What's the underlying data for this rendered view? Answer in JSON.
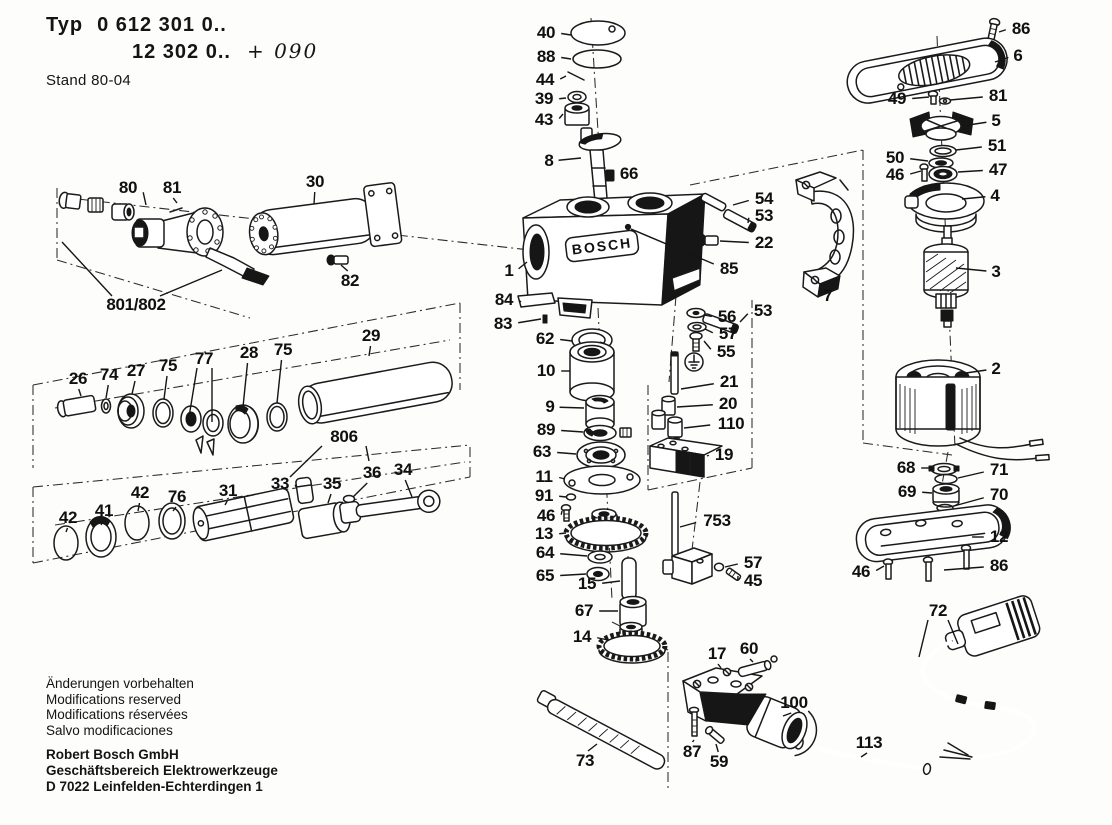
{
  "header": {
    "typ_label": "Typ",
    "line1": "0 612 301 0..",
    "line2": "12 302 0..",
    "handwritten": "+ 090",
    "stand": "Stand 80-04"
  },
  "logo_text": "BOSCH",
  "footer": {
    "notes": [
      "Änderungen vorbehalten",
      "Modifications reserved",
      "Modifications réservées",
      "Salvo modificaciones"
    ],
    "company": [
      "Robert Bosch GmbH",
      "Geschäftsbereich Elektrowerkzeuge",
      "D 7022 Leinfelden-Echterdingen 1"
    ]
  },
  "parts": [
    {
      "id": "p40",
      "label": "40",
      "x": 546,
      "y": 33,
      "tx": 571,
      "ty": 35
    },
    {
      "id": "p88",
      "label": "88",
      "x": 546,
      "y": 57,
      "tx": 571,
      "ty": 59
    },
    {
      "id": "p44",
      "label": "44",
      "x": 545,
      "y": 80,
      "tx": 566,
      "ty": 76
    },
    {
      "id": "p39",
      "label": "39",
      "x": 544,
      "y": 99,
      "tx": 566,
      "ty": 98
    },
    {
      "id": "p43",
      "label": "43",
      "x": 544,
      "y": 120,
      "tx": 563,
      "ty": 114
    },
    {
      "id": "p8",
      "label": "8",
      "x": 549,
      "y": 161,
      "tx": 581,
      "ty": 158
    },
    {
      "id": "p66",
      "label": "66",
      "x": 629,
      "y": 174,
      "tx": 613,
      "ty": 175
    },
    {
      "id": "p86a",
      "label": "86",
      "x": 1021,
      "y": 29,
      "tx": 999,
      "ty": 32
    },
    {
      "id": "p6",
      "label": "6",
      "x": 1018,
      "y": 56,
      "tx": 995,
      "ty": 62
    },
    {
      "id": "p49",
      "label": "49",
      "x": 897,
      "y": 99,
      "tx": 929,
      "ty": 97
    },
    {
      "id": "p81b",
      "label": "81",
      "x": 998,
      "y": 96,
      "tx": 950,
      "ty": 100
    },
    {
      "id": "p5",
      "label": "5",
      "x": 996,
      "y": 121,
      "tx": 962,
      "ty": 126
    },
    {
      "id": "p51",
      "label": "51",
      "x": 997,
      "y": 146,
      "tx": 956,
      "ty": 150
    },
    {
      "id": "p50",
      "label": "50",
      "x": 895,
      "y": 158,
      "tx": 928,
      "ty": 161
    },
    {
      "id": "p46b",
      "label": "46",
      "x": 895,
      "y": 175,
      "tx": 921,
      "ty": 171
    },
    {
      "id": "p47",
      "label": "47",
      "x": 998,
      "y": 170,
      "tx": 958,
      "ty": 172
    },
    {
      "id": "p4",
      "label": "4",
      "x": 995,
      "y": 196,
      "tx": 962,
      "ty": 199
    },
    {
      "id": "p3",
      "label": "3",
      "x": 996,
      "y": 272,
      "tx": 956,
      "ty": 268
    },
    {
      "id": "p2",
      "label": "2",
      "x": 996,
      "y": 369,
      "tx": 966,
      "ty": 373
    },
    {
      "id": "p80",
      "label": "80",
      "x": 128,
      "y": 188,
      "tx": 146,
      "ty": 205
    },
    {
      "id": "p81a",
      "label": "81",
      "x": 172,
      "y": 188,
      "tx": 177,
      "ty": 203
    },
    {
      "id": "p30",
      "label": "30",
      "x": 315,
      "y": 182,
      "tx": 314,
      "ty": 204
    },
    {
      "id": "p82",
      "label": "82",
      "x": 350,
      "y": 281,
      "tx": 341,
      "ty": 265
    },
    {
      "id": "p801",
      "label": "801/802",
      "x": 136,
      "y": 305
    },
    {
      "id": "p54",
      "label": "54",
      "x": 764,
      "y": 199,
      "tx": 733,
      "ty": 205
    },
    {
      "id": "p53a",
      "label": "53",
      "x": 764,
      "y": 216,
      "tx": 748,
      "ty": 223
    },
    {
      "id": "p22",
      "label": "22",
      "x": 764,
      "y": 243,
      "tx": 720,
      "ty": 241
    },
    {
      "id": "p85",
      "label": "85",
      "x": 729,
      "y": 269,
      "tx": 631,
      "ty": 229
    },
    {
      "id": "p1",
      "label": "1",
      "x": 509,
      "y": 271,
      "tx": 527,
      "ty": 262
    },
    {
      "id": "p84",
      "label": "84",
      "x": 504,
      "y": 300,
      "tx": 521,
      "ty": 302
    },
    {
      "id": "p83",
      "label": "83",
      "x": 503,
      "y": 324,
      "tx": 541,
      "ty": 319
    },
    {
      "id": "p53b",
      "label": "53",
      "x": 763,
      "y": 311,
      "tx": 740,
      "ty": 322
    },
    {
      "id": "p56",
      "label": "56",
      "x": 727,
      "y": 317,
      "tx": 704,
      "ty": 315
    },
    {
      "id": "p57a",
      "label": "57",
      "x": 728,
      "y": 334,
      "tx": 705,
      "ty": 329
    },
    {
      "id": "p55",
      "label": "55",
      "x": 726,
      "y": 352,
      "tx": 704,
      "ty": 341
    },
    {
      "id": "p26",
      "label": "26",
      "x": 78,
      "y": 379,
      "tx": 81,
      "ty": 396
    },
    {
      "id": "p74",
      "label": "74",
      "x": 109,
      "y": 375,
      "tx": 106,
      "ty": 398
    },
    {
      "id": "p27",
      "label": "27",
      "x": 136,
      "y": 371,
      "tx": 132,
      "ty": 394
    },
    {
      "id": "p75a",
      "label": "75",
      "x": 168,
      "y": 366,
      "tx": 164,
      "ty": 399
    },
    {
      "id": "p77",
      "label": "77",
      "x": 204,
      "y": 359
    },
    {
      "id": "p28",
      "label": "28",
      "x": 249,
      "y": 353,
      "tx": 243,
      "ty": 407
    },
    {
      "id": "p75b",
      "label": "75",
      "x": 283,
      "y": 350,
      "tx": 277,
      "ty": 403
    },
    {
      "id": "p29",
      "label": "29",
      "x": 371,
      "y": 336,
      "tx": 369,
      "ty": 356
    },
    {
      "id": "p62",
      "label": "62",
      "x": 545,
      "y": 339,
      "tx": 572,
      "ty": 341
    },
    {
      "id": "p10",
      "label": "10",
      "x": 546,
      "y": 371,
      "tx": 570,
      "ty": 371
    },
    {
      "id": "p9",
      "label": "9",
      "x": 550,
      "y": 407,
      "tx": 584,
      "ty": 408
    },
    {
      "id": "p89",
      "label": "89",
      "x": 546,
      "y": 430,
      "tx": 583,
      "ty": 432
    },
    {
      "id": "p63",
      "label": "63",
      "x": 542,
      "y": 452,
      "tx": 576,
      "ty": 454
    },
    {
      "id": "p11",
      "label": "11",
      "x": 544,
      "y": 477,
      "tx": 565,
      "ty": 479
    },
    {
      "id": "p91",
      "label": "91",
      "x": 544,
      "y": 496,
      "tx": 566,
      "ty": 497
    },
    {
      "id": "p46c",
      "label": "46",
      "x": 546,
      "y": 516,
      "tx": 562,
      "ty": 511
    },
    {
      "id": "p13",
      "label": "13",
      "x": 544,
      "y": 534,
      "tx": 566,
      "ty": 533
    },
    {
      "id": "p64",
      "label": "64",
      "x": 545,
      "y": 553,
      "tx": 587,
      "ty": 556
    },
    {
      "id": "p65",
      "label": "65",
      "x": 545,
      "y": 576,
      "tx": 586,
      "ty": 574
    },
    {
      "id": "p15",
      "label": "15",
      "x": 587,
      "y": 584,
      "tx": 620,
      "ty": 581
    },
    {
      "id": "p67",
      "label": "67",
      "x": 584,
      "y": 611,
      "tx": 618,
      "ty": 611
    },
    {
      "id": "p14",
      "label": "14",
      "x": 582,
      "y": 637,
      "tx": 608,
      "ty": 640
    },
    {
      "id": "p21",
      "label": "21",
      "x": 729,
      "y": 382,
      "tx": 681,
      "ty": 389
    },
    {
      "id": "p20",
      "label": "20",
      "x": 728,
      "y": 404,
      "tx": 677,
      "ty": 407
    },
    {
      "id": "p110",
      "label": "110",
      "x": 731,
      "y": 424,
      "tx": 684,
      "ty": 428
    },
    {
      "id": "p19",
      "label": "19",
      "x": 724,
      "y": 455,
      "tx": 707,
      "ty": 456
    },
    {
      "id": "p753",
      "label": "753",
      "x": 717,
      "y": 521,
      "tx": 680,
      "ty": 527
    },
    {
      "id": "p57b",
      "label": "57",
      "x": 753,
      "y": 563,
      "tx": 725,
      "ty": 567
    },
    {
      "id": "p45",
      "label": "45",
      "x": 753,
      "y": 581,
      "tx": 738,
      "ty": 576
    },
    {
      "id": "p806",
      "label": "806",
      "x": 344,
      "y": 437
    },
    {
      "id": "p33",
      "label": "33",
      "x": 280,
      "y": 484,
      "tx": 296,
      "ty": 487
    },
    {
      "id": "p35",
      "label": "35",
      "x": 332,
      "y": 484,
      "tx": 328,
      "ty": 503
    },
    {
      "id": "p36",
      "label": "36",
      "x": 372,
      "y": 473,
      "tx": 353,
      "ty": 497
    },
    {
      "id": "p34",
      "label": "34",
      "x": 403,
      "y": 470,
      "tx": 412,
      "ty": 497
    },
    {
      "id": "p31",
      "label": "31",
      "x": 228,
      "y": 491,
      "tx": 225,
      "ty": 505
    },
    {
      "id": "p76",
      "label": "76",
      "x": 177,
      "y": 497,
      "tx": 173,
      "ty": 511
    },
    {
      "id": "p42a",
      "label": "42",
      "x": 140,
      "y": 493,
      "tx": 138,
      "ty": 511
    },
    {
      "id": "p41",
      "label": "41",
      "x": 104,
      "y": 511,
      "tx": 101,
      "ty": 525
    },
    {
      "id": "p42b",
      "label": "42",
      "x": 68,
      "y": 518,
      "tx": 66,
      "ty": 532
    },
    {
      "id": "p68",
      "label": "68",
      "x": 906,
      "y": 468,
      "tx": 930,
      "ty": 468
    },
    {
      "id": "p71",
      "label": "71",
      "x": 999,
      "y": 470,
      "tx": 958,
      "ty": 478
    },
    {
      "id": "p69",
      "label": "69",
      "x": 907,
      "y": 492,
      "tx": 932,
      "ty": 493
    },
    {
      "id": "p70",
      "label": "70",
      "x": 999,
      "y": 495,
      "tx": 954,
      "ty": 506
    },
    {
      "id": "p12",
      "label": "12",
      "x": 999,
      "y": 537,
      "tx": 972,
      "ty": 537
    },
    {
      "id": "p46d",
      "label": "46",
      "x": 861,
      "y": 572,
      "tx": 884,
      "ty": 566
    },
    {
      "id": "p86c",
      "label": "86",
      "x": 999,
      "y": 566,
      "tx": 944,
      "ty": 570
    },
    {
      "id": "p72",
      "label": "72",
      "x": 938,
      "y": 611
    },
    {
      "id": "p17",
      "label": "17",
      "x": 717,
      "y": 654,
      "tx": 721,
      "ty": 668
    },
    {
      "id": "p60",
      "label": "60",
      "x": 749,
      "y": 649,
      "tx": 753,
      "ty": 662
    },
    {
      "id": "p100",
      "label": "100",
      "x": 794,
      "y": 703,
      "tx": 783,
      "ty": 716
    },
    {
      "id": "p87",
      "label": "87",
      "x": 692,
      "y": 752,
      "tx": 694,
      "ty": 740
    },
    {
      "id": "p59",
      "label": "59",
      "x": 719,
      "y": 762,
      "tx": 716,
      "ty": 744
    },
    {
      "id": "p73",
      "label": "73",
      "x": 585,
      "y": 761,
      "tx": 597,
      "ty": 744
    },
    {
      "id": "p113",
      "label": "113",
      "x": 869,
      "y": 743,
      "tx": 861,
      "ty": 757
    },
    {
      "id": "p7",
      "label": "7",
      "x": 828,
      "y": 296,
      "tx": 822,
      "ty": 284
    }
  ]
}
